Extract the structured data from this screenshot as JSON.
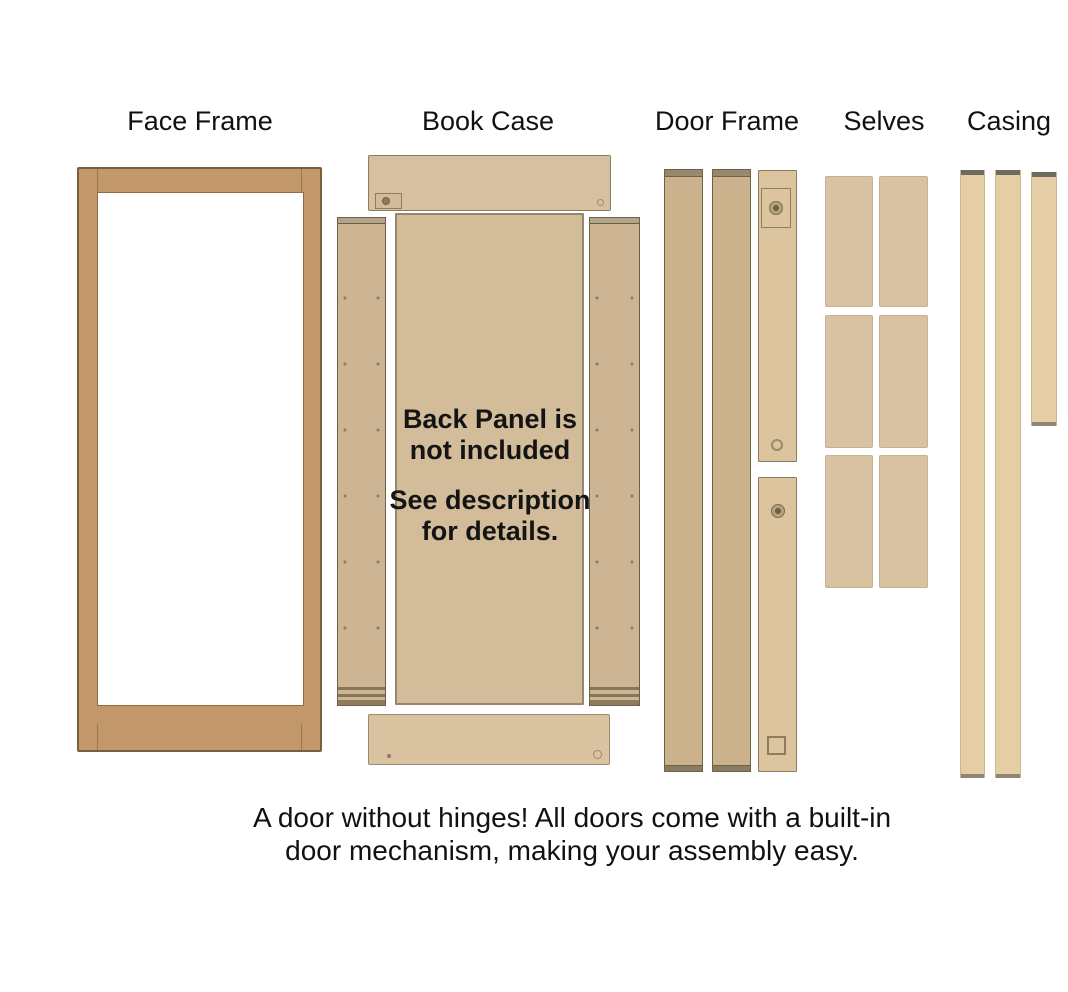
{
  "canvas": {
    "width": 1068,
    "height": 992,
    "background": "#ffffff"
  },
  "labels": {
    "face_frame": "Face Frame",
    "book_case": "Book Case",
    "door_frame": "Door Frame",
    "shelves": "Selves",
    "casing": "Casing"
  },
  "back_panel_note": {
    "line1": "Back Panel is",
    "line2": "not included",
    "line3": "See description",
    "line4": "for details."
  },
  "caption": {
    "line1": "A door without hinges! All doors come with a built-in",
    "line2": "door mechanism, making your assembly easy."
  },
  "piece_counts": {
    "shelf_panels": 6,
    "casing_strips": 3,
    "door_frame_strips": 2,
    "hinge_strips": 2,
    "bookcase_side_panels": 2
  },
  "colors": {
    "background": "#ffffff",
    "face_frame_wood": "#c2986a",
    "face_frame_outline": "#7a5f3e",
    "bookcase_panel_wood": "#d6c09f",
    "bookcase_side_wood": "#cdb593",
    "back_panel_wood": "#d3bc99",
    "door_strip_wood": "#cbb28d",
    "hinge_strip_wood": "#dbc49e",
    "shelf_wood": "#d8c2a2",
    "casing_wood": "#e5cda6",
    "end_cap_dark": "#6f6a5e",
    "outline_dark": "#6e6148",
    "text": "#111111"
  }
}
